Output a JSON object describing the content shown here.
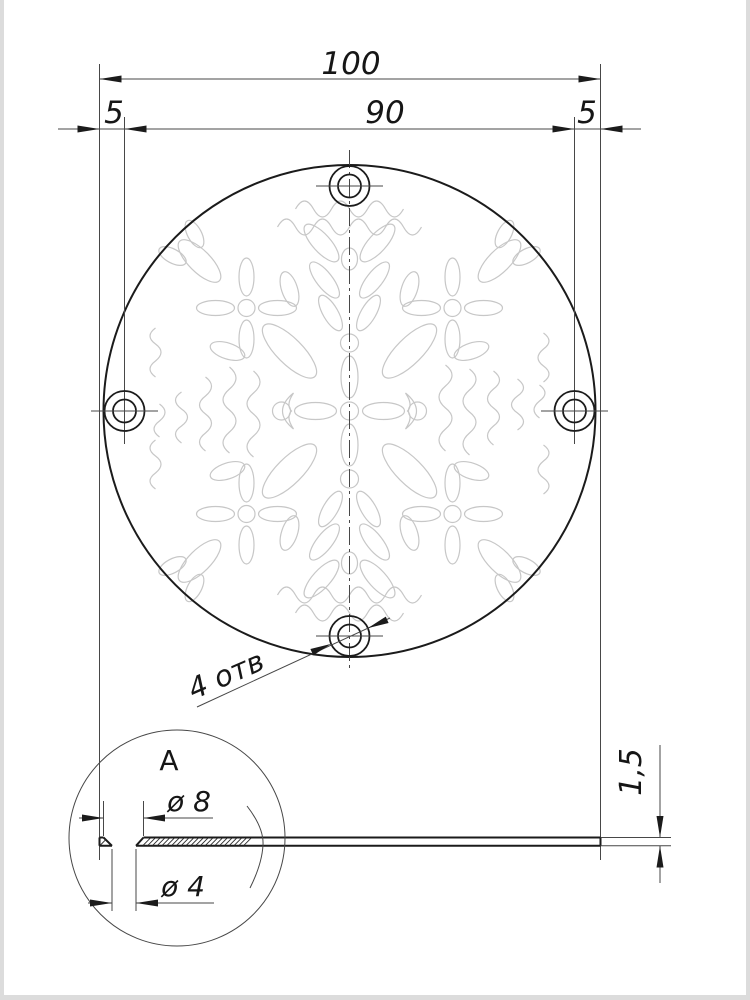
{
  "drawing": {
    "dimensions": {
      "overall": "100",
      "bolt_spacing": "90",
      "edge_offset_left": "5",
      "edge_offset_right": "5",
      "thickness": "1,5",
      "countersink_diameter": "ø 8",
      "hole_diameter": "ø 4"
    },
    "notes": {
      "holes_count": "4 отв"
    },
    "detail": {
      "label": "А"
    },
    "colors": {
      "outline": "#1b1b1b",
      "thin_line": "#474747",
      "ornament": "#c7c7c7",
      "page_edge": "#dcdcdc",
      "background": "#ffffff"
    }
  }
}
